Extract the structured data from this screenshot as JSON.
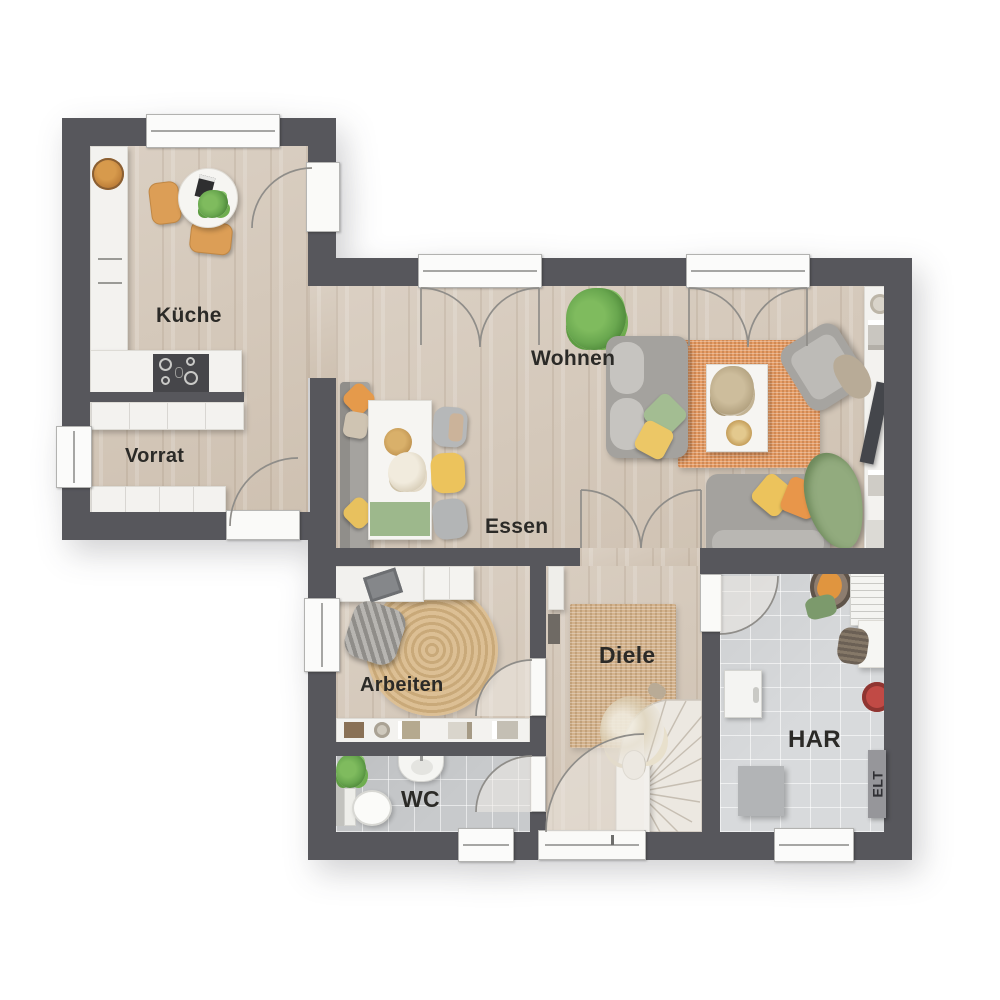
{
  "rooms": {
    "kueche": {
      "label": "Küche"
    },
    "vorrat": {
      "label": "Vorrat"
    },
    "wohnen": {
      "label": "Wohnen"
    },
    "essen": {
      "label": "Essen"
    },
    "arbeiten": {
      "label": "Arbeiten"
    },
    "diele": {
      "label": "Diele"
    },
    "wc": {
      "label": "WC"
    },
    "har": {
      "label": "HAR"
    },
    "elt_box": {
      "label": "ELT"
    }
  },
  "colors": {
    "wall": "#57575c",
    "wood_floor": "#d6cabc",
    "tile_wc": "#c8cacc",
    "tile_har": "#d8dadc",
    "rug_orange": "#e79d66",
    "rug_jute": "#d3b28c",
    "furniture_white": "#f3f2ef",
    "sofa_gray": "#a4a29e",
    "accent_yellow": "#ecc35c",
    "accent_orange": "#e8964a",
    "accent_green": "#92ab7e",
    "plant_green": "#69a74f"
  }
}
